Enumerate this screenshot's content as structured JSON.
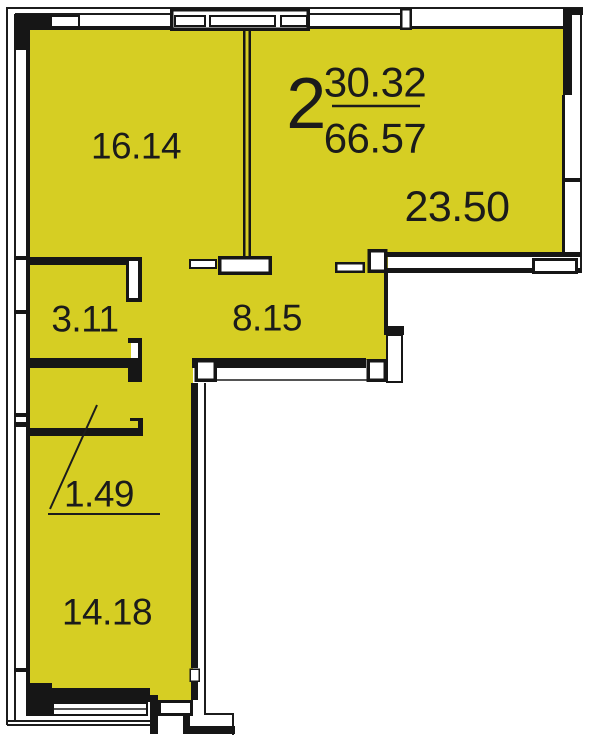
{
  "plan_title": "Apartment floor plan",
  "unit": {
    "number": "2",
    "living_area": "30.32",
    "total_area": "66.57"
  },
  "rooms": [
    {
      "id": "room-16-14",
      "area": "16.14"
    },
    {
      "id": "room-23-50",
      "area": "23.50"
    },
    {
      "id": "room-3-11",
      "area": "3.11"
    },
    {
      "id": "room-8-15",
      "area": "8.15"
    },
    {
      "id": "room-1-49",
      "area": "1.49"
    },
    {
      "id": "room-14-18",
      "area": "14.18"
    }
  ],
  "colors": {
    "room_fill": "#d6ce23",
    "wall": "#161616",
    "line": "#1c1c1c",
    "background": "#ffffff",
    "text": "#1b1b1b"
  }
}
